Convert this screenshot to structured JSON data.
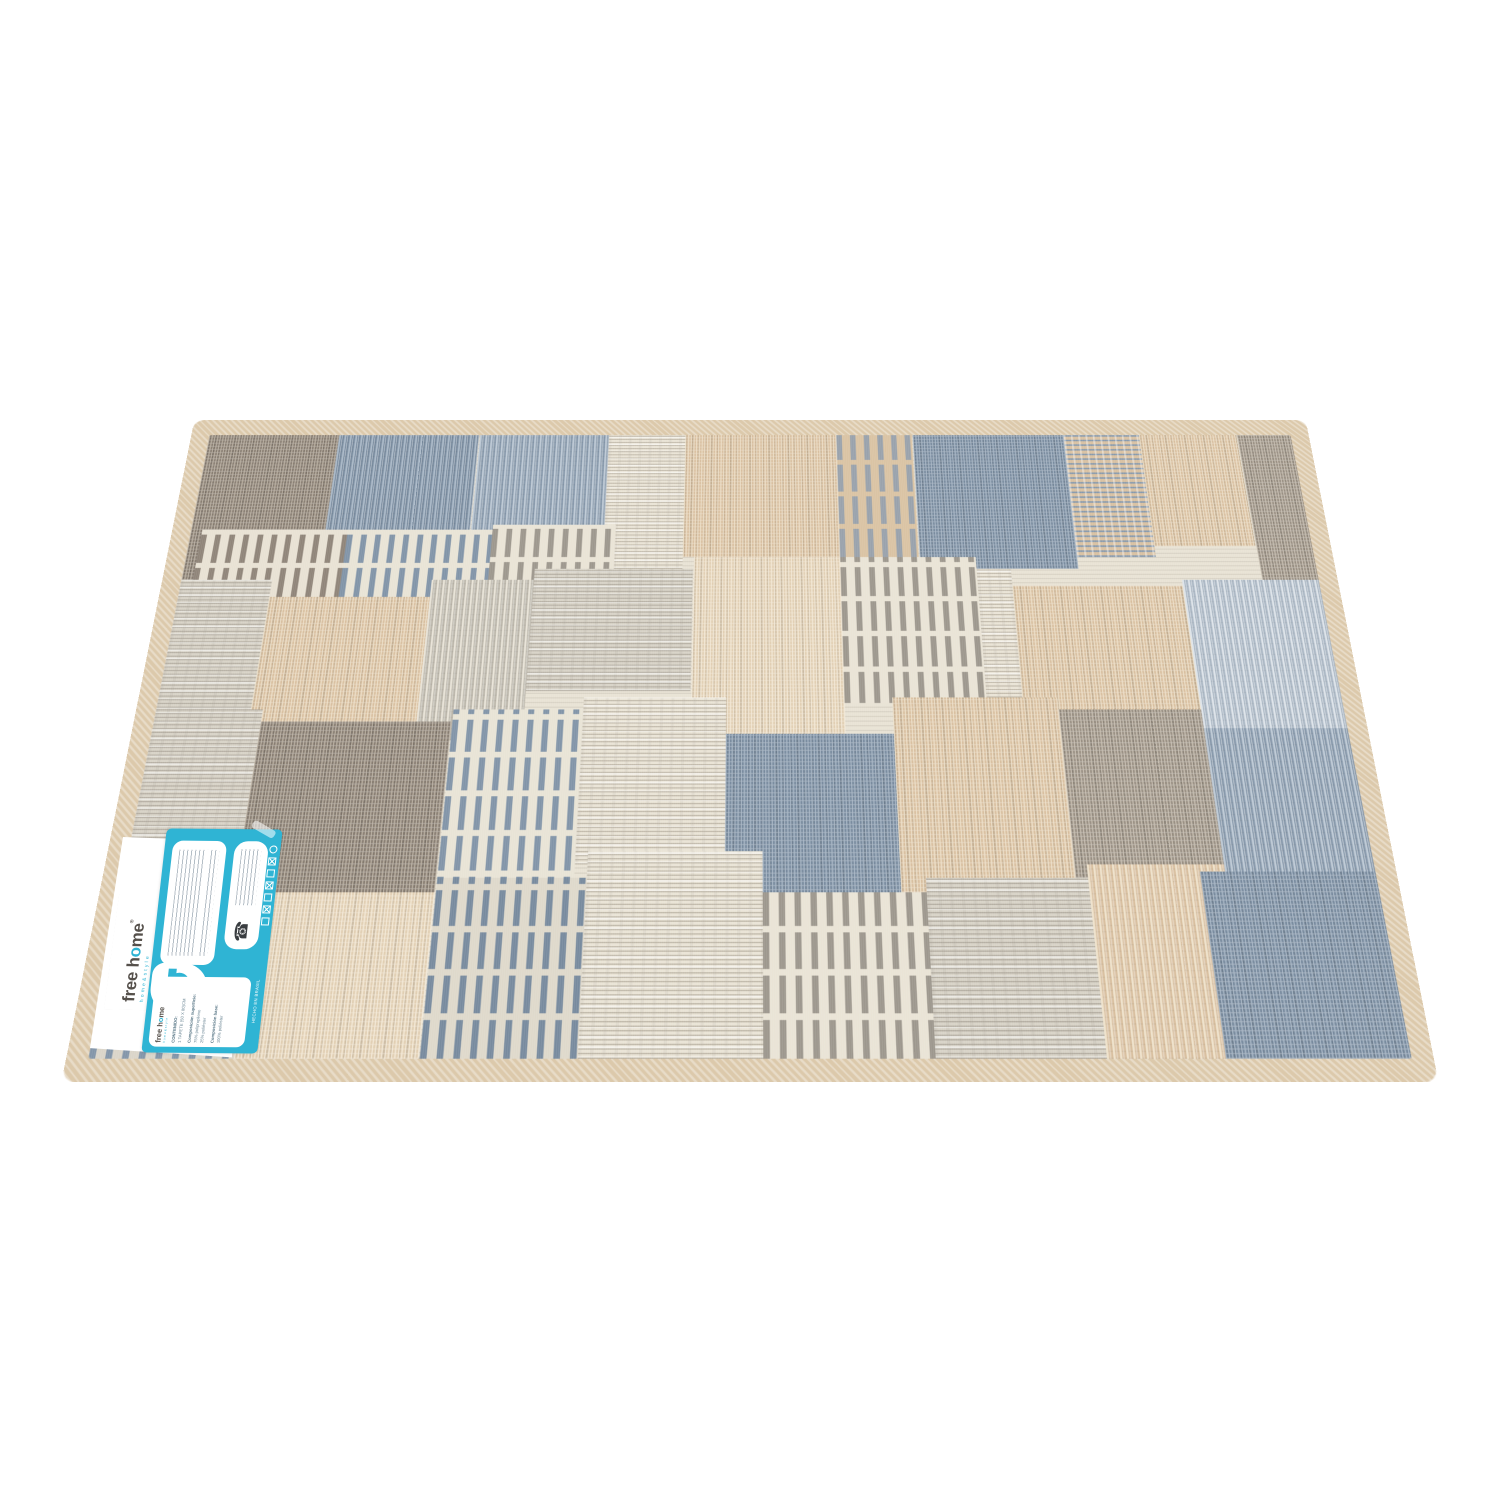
{
  "scene": {
    "background_color": "#ffffff",
    "description": "product photo of patchwork mat with brand labels, white background"
  },
  "rug": {
    "border_color": "#dcc9ab",
    "base_color": "#e8e2d4",
    "palette": {
      "taupe": "#968c7f",
      "taupe_dark": "#84796d",
      "blue_grey": "#8496a9",
      "blue_dark": "#74879b",
      "blue_light": "#a9b6c3",
      "beige": "#d7bd9c",
      "beige_light": "#e0cdb0",
      "cream": "#e9e3d5",
      "grey_light": "#d7d2c6"
    },
    "patches": [
      {
        "x": 0,
        "y": 0,
        "w": 12,
        "h": 27,
        "tx": "mottle",
        "p": "taupeDark"
      },
      {
        "x": 12,
        "y": 0,
        "w": 13,
        "h": 26,
        "tx": "vstreak",
        "p": "blueDk"
      },
      {
        "x": 25,
        "y": 0,
        "w": 12,
        "h": 26,
        "tx": "vstreak",
        "p": "blue"
      },
      {
        "x": 37,
        "y": 0,
        "w": 7,
        "h": 25,
        "tx": "hstreak",
        "p": "cream"
      },
      {
        "x": 44,
        "y": 0,
        "w": 14,
        "h": 23,
        "tx": "mottle",
        "p": "beige"
      },
      {
        "x": 58,
        "y": 0,
        "w": 7,
        "h": 23,
        "tx": "comb",
        "p": "greyOnBeige"
      },
      {
        "x": 65,
        "y": 0,
        "w": 14,
        "h": 25,
        "tx": "mottle",
        "p": "blueDk"
      },
      {
        "x": 79,
        "y": 0,
        "w": 7,
        "h": 23,
        "tx": "hdash",
        "p": "blueOnBeige"
      },
      {
        "x": 86,
        "y": 0,
        "w": 9,
        "h": 21,
        "tx": "mottle",
        "p": "beige"
      },
      {
        "x": 95,
        "y": 0,
        "w": 5,
        "h": 34,
        "tx": "mottle",
        "p": "taupe"
      },
      {
        "x": 1,
        "y": 18,
        "w": 13,
        "h": 12,
        "tx": "comb",
        "p": "taupeOnCream"
      },
      {
        "x": 14,
        "y": 18,
        "w": 13,
        "h": 12,
        "tx": "comb",
        "p": "blueOnCream"
      },
      {
        "x": 27,
        "y": 17,
        "w": 11,
        "h": 12,
        "tx": "comb",
        "p": "greyOnCream"
      },
      {
        "x": 0,
        "y": 27,
        "w": 8,
        "h": 26,
        "tx": "hstreak",
        "p": "greyLight"
      },
      {
        "x": 8,
        "y": 30,
        "w": 14,
        "h": 27,
        "tx": "mottle",
        "p": "beige"
      },
      {
        "x": 22,
        "y": 27,
        "w": 9,
        "h": 27,
        "tx": "vstreak",
        "p": "grey"
      },
      {
        "x": 31,
        "y": 25,
        "w": 14,
        "h": 21,
        "tx": "hstreak",
        "p": "greyLight"
      },
      {
        "x": 45,
        "y": 23,
        "w": 13,
        "h": 31,
        "tx": "mottle",
        "p": "beigeLight"
      },
      {
        "x": 58,
        "y": 23,
        "w": 12,
        "h": 25,
        "tx": "comb",
        "p": "greyOnCream"
      },
      {
        "x": 70,
        "y": 25,
        "w": 3,
        "h": 25,
        "tx": "hstreak",
        "p": "cream"
      },
      {
        "x": 73,
        "y": 28,
        "w": 15,
        "h": 31,
        "tx": "mottle",
        "p": "beige"
      },
      {
        "x": 88,
        "y": 27,
        "w": 12,
        "h": 31,
        "tx": "vstreak",
        "p": "blueLight"
      },
      {
        "x": 0,
        "y": 49,
        "w": 9,
        "h": 28,
        "tx": "hstreak",
        "p": "greyLight"
      },
      {
        "x": 9,
        "y": 51,
        "w": 16,
        "h": 31,
        "tx": "mottle",
        "p": "taupeDark"
      },
      {
        "x": 25,
        "y": 49,
        "w": 11,
        "h": 31,
        "tx": "comb",
        "p": "blueOnCream"
      },
      {
        "x": 36,
        "y": 47,
        "w": 12,
        "h": 26,
        "tx": "hstreak",
        "p": "cream"
      },
      {
        "x": 48,
        "y": 53,
        "w": 14,
        "h": 31,
        "tx": "mottle",
        "p": "blueDk"
      },
      {
        "x": 62,
        "y": 47,
        "w": 14,
        "h": 41,
        "tx": "mottle",
        "p": "beige"
      },
      {
        "x": 76,
        "y": 49,
        "w": 12,
        "h": 29,
        "tx": "mottle",
        "p": "taupe"
      },
      {
        "x": 88,
        "y": 52,
        "w": 12,
        "h": 48,
        "tx": "vstreak",
        "p": "blue"
      },
      {
        "x": 0,
        "y": 73,
        "w": 11,
        "h": 27,
        "tx": "comb",
        "p": "blueOnGrey"
      },
      {
        "x": 11,
        "y": 77,
        "w": 14,
        "h": 23,
        "tx": "mottle",
        "p": "beigeLight"
      },
      {
        "x": 25,
        "y": 75,
        "w": 12,
        "h": 25,
        "tx": "comb",
        "p": "blueDense"
      },
      {
        "x": 37,
        "y": 71,
        "w": 14,
        "h": 29,
        "tx": "hstreak",
        "p": "cream"
      },
      {
        "x": 51,
        "y": 77,
        "w": 13,
        "h": 23,
        "tx": "comb",
        "p": "greyOnCream"
      },
      {
        "x": 64,
        "y": 75,
        "w": 13,
        "h": 25,
        "tx": "hstreak",
        "p": "greyLight"
      },
      {
        "x": 77,
        "y": 73,
        "w": 11,
        "h": 27,
        "tx": "vstreak",
        "p": "beige"
      },
      {
        "x": 86,
        "y": 74,
        "w": 14,
        "h": 26,
        "tx": "mottle",
        "p": "blueDk"
      }
    ]
  },
  "label": {
    "accent_color": "#2fb4d4",
    "brand_part1": "free h",
    "brand_o": "o",
    "brand_part2": "me",
    "registered": "®",
    "brand_sub": "home&style",
    "card": {
      "contents_label": "CONTENIDO:",
      "contents_value": "1 TAPETE (50 X 80)CM",
      "surface_label": "Composición superficie:",
      "surface_value_1": "75% polipropileno",
      "surface_value_2": "25% poliéster",
      "base_label": "Composición base:",
      "base_value": "100% poliéster",
      "origin": "HECHO EN BRASIL",
      "phone_glyph": "☎",
      "care_symbols": [
        "wash",
        "bleach",
        "tumble-dry",
        "iron",
        "dry-clean",
        "wring",
        "professional-clean"
      ]
    }
  }
}
